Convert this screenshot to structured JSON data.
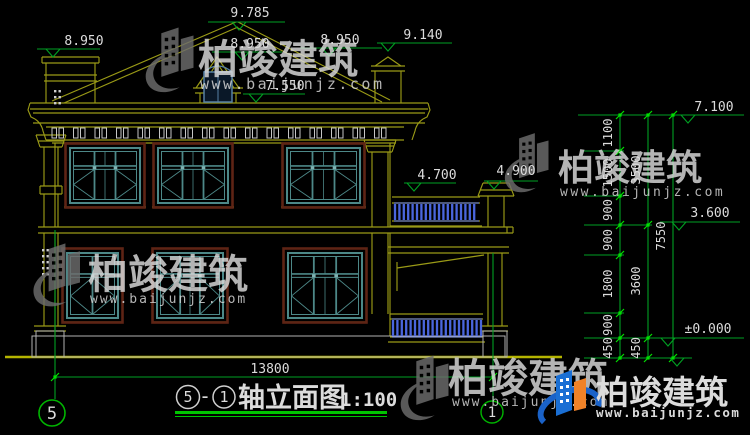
{
  "drawing_title": {
    "axis_from": "5",
    "separator": "-",
    "axis_to": "1",
    "name": "轴立面图",
    "scale": "1:100"
  },
  "axis_bubbles": {
    "left": "5",
    "right": "1"
  },
  "elevations": {
    "ridge": "9.785",
    "left_parapet": "8.950",
    "mid_roof": "8.950",
    "right_roof": "8.950",
    "chimney": "9.140",
    "dormer": "7.550",
    "eave": "7.100",
    "balcony_rail": "4.700",
    "balcony_pillar": "4.900",
    "second_floor": "3.600",
    "ground": "±0.000"
  },
  "dim_chains": {
    "right_inner": [
      "1100",
      "1500",
      "900",
      "900",
      "1800",
      "900",
      "450"
    ],
    "right_middle": [
      "3500",
      "3600",
      "450"
    ],
    "right_total": "7550",
    "bottom_width": "13800"
  },
  "watermark": {
    "brand": "柏竣建筑",
    "url": "www.baijunjz.com"
  }
}
